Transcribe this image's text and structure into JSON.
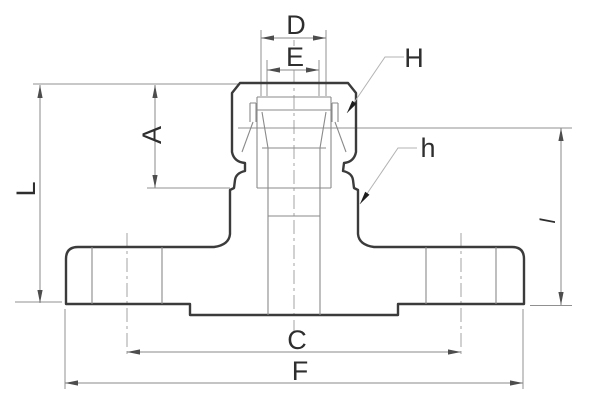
{
  "drawing": {
    "kind": "flanged camlock adapter fitting, sectional dimension drawing",
    "colors": {
      "background": "#ffffff",
      "outline": "#3b3b3b",
      "thin_lines": "#8a8a8a",
      "text": "#2e2e2e"
    },
    "labels": {
      "D": "D",
      "E": "E",
      "H": "H",
      "h_lower": "h",
      "A": "A",
      "L": "L",
      "l_lower": "l",
      "C": "C",
      "F": "F"
    }
  }
}
